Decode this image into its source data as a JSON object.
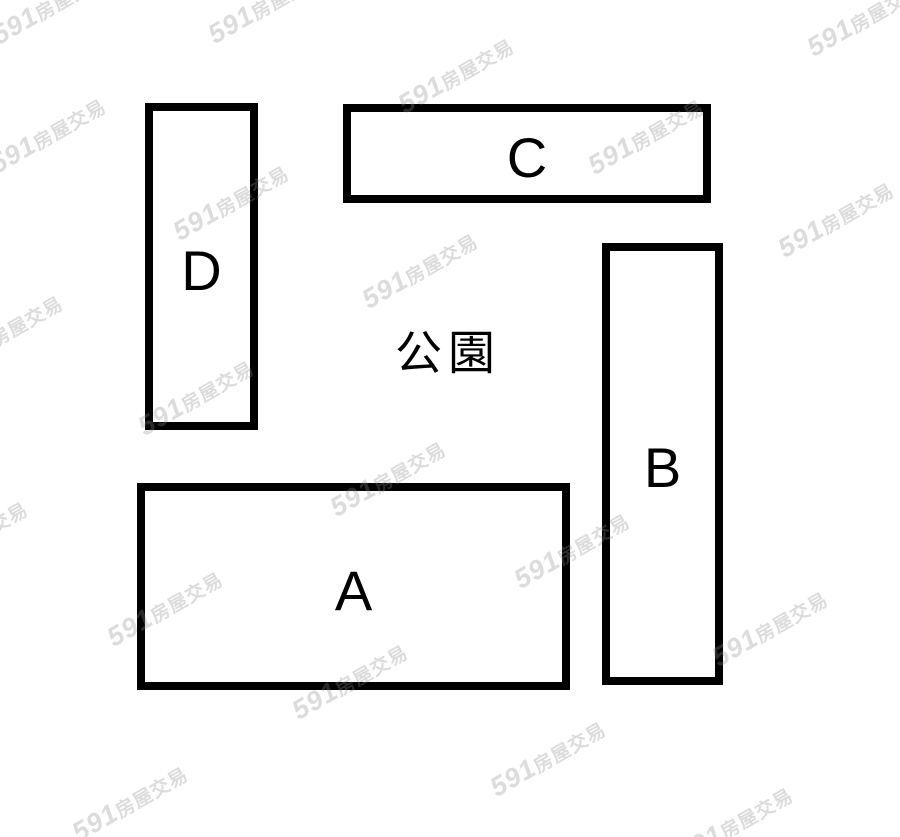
{
  "diagram": {
    "type": "floorplan-sketch",
    "center_label_text": "公園",
    "center_label_pos": {
      "x": 448,
      "y": 349,
      "font_size": 47
    },
    "blocks": [
      {
        "label": "A",
        "x": 137,
        "y": 483,
        "w": 433,
        "h": 207
      },
      {
        "label": "B",
        "x": 602,
        "y": 243,
        "w": 121,
        "h": 442
      },
      {
        "label": "C",
        "x": 343,
        "y": 104,
        "w": 368,
        "h": 99
      },
      {
        "label": "D",
        "x": 145,
        "y": 103,
        "w": 113,
        "h": 327
      }
    ],
    "style": {
      "background": "#ffffff",
      "border_color": "#000000",
      "border_width": 8,
      "label_color": "#000000",
      "label_font_size": 56
    }
  },
  "watermark": {
    "brand": "591",
    "suffix": "房屋交易",
    "color": "rgba(140,140,140,0.3)",
    "rotation_deg": -30,
    "positions": [
      {
        "x": 50,
        "y": 6
      },
      {
        "x": 266,
        "y": 5
      },
      {
        "x": 456,
        "y": 75
      },
      {
        "x": 865,
        "y": 18
      },
      {
        "x": 48,
        "y": 135
      },
      {
        "x": 231,
        "y": 202
      },
      {
        "x": 420,
        "y": 270
      },
      {
        "x": 646,
        "y": 136
      },
      {
        "x": 836,
        "y": 219
      },
      {
        "x": 5,
        "y": 332
      },
      {
        "x": 196,
        "y": 397
      },
      {
        "x": 388,
        "y": 478
      },
      {
        "x": 572,
        "y": 550
      },
      {
        "x": 770,
        "y": 628
      },
      {
        "x": -30,
        "y": 538
      },
      {
        "x": 165,
        "y": 608
      },
      {
        "x": 350,
        "y": 681
      },
      {
        "x": 548,
        "y": 758
      },
      {
        "x": 735,
        "y": 824
      },
      {
        "x": 130,
        "y": 803
      }
    ]
  }
}
